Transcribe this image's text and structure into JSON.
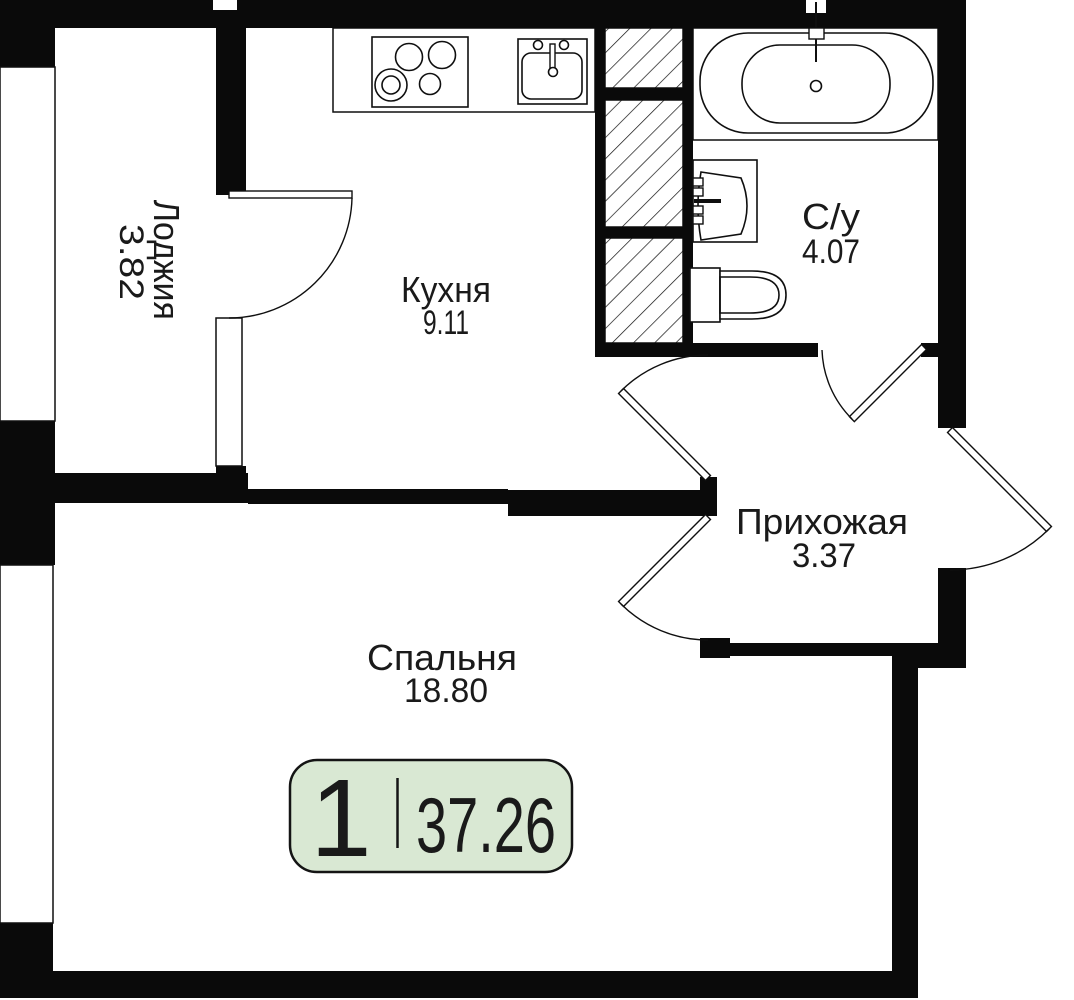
{
  "rooms": [
    {
      "name": "Лоджия",
      "area": "3.82"
    },
    {
      "name": "Кухня",
      "area": "9.11"
    },
    {
      "name": "С/у",
      "area": "4.07"
    },
    {
      "name": "Прихожая",
      "area": "3.37"
    },
    {
      "name": "Спальня",
      "area": "18.80"
    }
  ],
  "badge": {
    "rooms_count": "1",
    "total_area": "37.26",
    "fill": "#d9e8d3",
    "border": "#141414"
  },
  "colors": {
    "walls": "#0a0a0a",
    "lines": "#0f0f0f",
    "text": "#1a1a1a",
    "background": "#ffffff"
  },
  "fixtures": [
    "stove",
    "kitchen-sink",
    "ventilation-shaft",
    "bathtub",
    "washbasin",
    "toilet"
  ]
}
